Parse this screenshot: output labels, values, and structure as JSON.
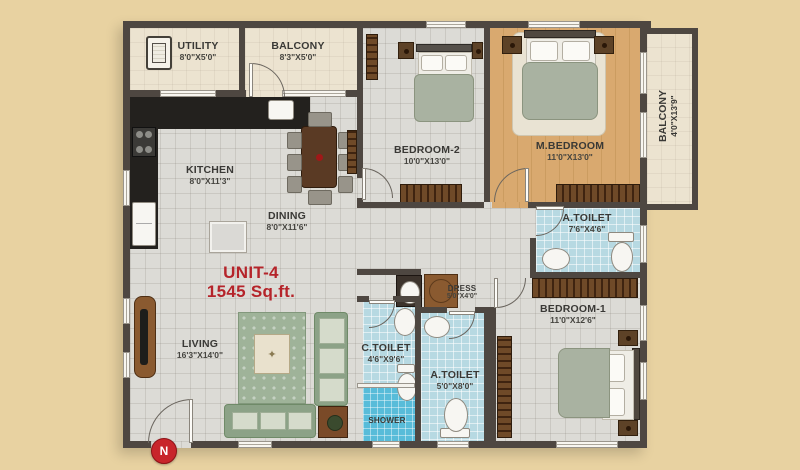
{
  "unit": {
    "name": "UNIT-4",
    "area": "1545 Sq.ft."
  },
  "compass": {
    "label": "N"
  },
  "rooms": [
    {
      "name": "UTILITY",
      "dims": "8'0\"X5'0\""
    },
    {
      "name": "BALCONY",
      "dims": "8'3\"X5'0\""
    },
    {
      "name": "KITCHEN",
      "dims": "8'0\"X11'3\""
    },
    {
      "name": "DINING",
      "dims": "8'0\"X11'6\""
    },
    {
      "name": "BEDROOM-2",
      "dims": "10'0\"X13'0\""
    },
    {
      "name": "M.BEDROOM",
      "dims": "11'0\"X13'0\""
    },
    {
      "name": "BALCONY",
      "dims": "4'0\"X13'9\""
    },
    {
      "name": "A.TOILET",
      "dims": "7'6\"X4'6\""
    },
    {
      "name": "DRESS",
      "dims": "5'0\"X4'0\""
    },
    {
      "name": "BEDROOM-1",
      "dims": "11'0\"X12'6\""
    },
    {
      "name": "C.TOILET",
      "dims": "4'6\"X9'6\""
    },
    {
      "name": "A.TOILET",
      "dims": "5'0\"X8'0\""
    },
    {
      "name": "SHOWER",
      "dims": ""
    },
    {
      "name": "LIVING",
      "dims": "16'3\"X14'0\""
    }
  ],
  "colors": {
    "background": "#e8d2a1",
    "wall": "#4e4741",
    "accent_red": "#b5242a",
    "floor_tile": "#dcdbd6",
    "floor_cream": "#ece3d0",
    "floor_wood": "#d9a96f",
    "toilet_blue": "#b7d9e2",
    "shower_blue": "#58bcd9",
    "sofa_green": "#8ca287",
    "counter_black": "#23211e",
    "wardrobe_brown": "#6f4a28"
  }
}
